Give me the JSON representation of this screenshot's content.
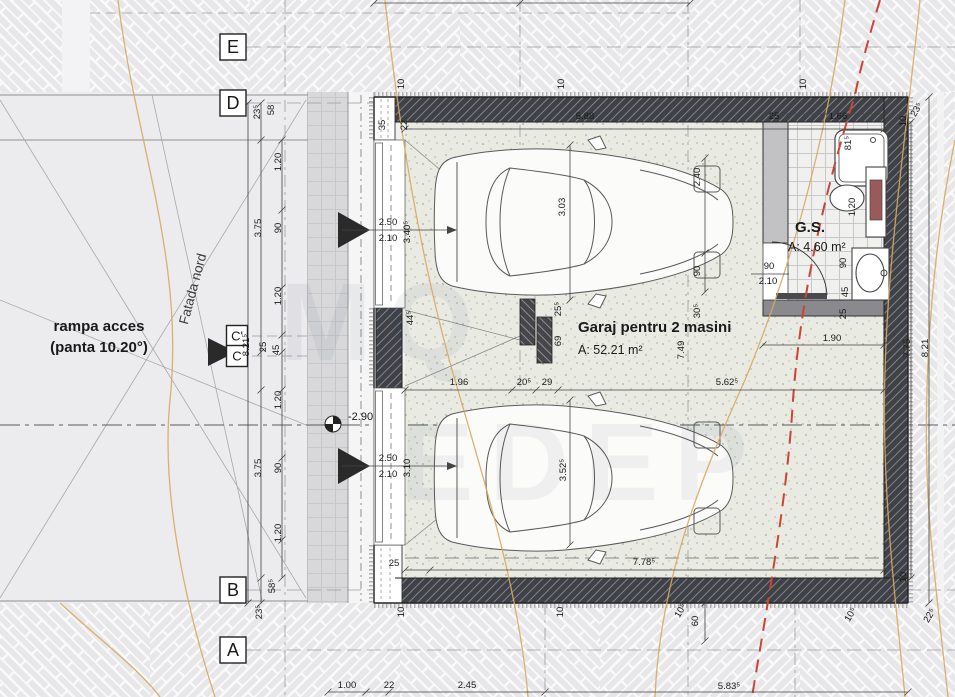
{
  "colors": {
    "wall": "#3f4146",
    "floor_stipple": "#e9ebe3",
    "pavement": "#e7e7e9",
    "tile_line": "#c8c8cb",
    "contour_line": "#d9a95f",
    "boundary_red_dashed": "#cc4433",
    "dimension_text": "#1a1a1a"
  },
  "texts": {
    "garage_title": "Garaj pentru 2 masini",
    "garage_area": "A: 52.21 m²",
    "gs_title": "G.S.",
    "gs_area": "A: 4.60 m²",
    "ramp_line1": "rampa acces",
    "ramp_line2": "(panta 10.20°)",
    "facade": "Fatada nord",
    "level": "-2.90",
    "watermark1": "MQ",
    "watermark2": "EDEP"
  },
  "grid_axes": [
    {
      "label": "E",
      "x": 233,
      "y": 47,
      "s": 26,
      "small": false
    },
    {
      "label": "D",
      "x": 233,
      "y": 103,
      "s": 26,
      "small": false
    },
    {
      "label": "C'",
      "x": 237,
      "y": 336,
      "s": 21,
      "small": true
    },
    {
      "label": "C",
      "x": 237,
      "y": 356,
      "s": 21,
      "small": true
    },
    {
      "label": "B",
      "x": 233,
      "y": 590,
      "s": 26,
      "small": false
    },
    {
      "label": "A",
      "x": 233,
      "y": 650,
      "s": 26,
      "small": false
    }
  ],
  "dimensions": [
    {
      "t": "5.88",
      "x": 585,
      "y": 119
    },
    {
      "t": "35",
      "x": 385,
      "y": 125,
      "r": -90
    },
    {
      "t": "22",
      "x": 407,
      "y": 125,
      "r": -90
    },
    {
      "t": "10",
      "x": 404,
      "y": 84,
      "r": -90
    },
    {
      "t": "10",
      "x": 564,
      "y": 84,
      "r": -90
    },
    {
      "t": "10",
      "x": 806,
      "y": 84,
      "r": -90
    },
    {
      "t": "10",
      "x": 906,
      "y": 121,
      "r": -90
    },
    {
      "t": "23⁵",
      "x": 919,
      "y": 111,
      "r": -60
    },
    {
      "t": "25",
      "x": 774,
      "y": 119
    },
    {
      "t": "1.66",
      "x": 838,
      "y": 119
    },
    {
      "t": "81⁵",
      "x": 851,
      "y": 143,
      "r": -90
    },
    {
      "t": "1.20",
      "x": 855,
      "y": 207,
      "r": -90
    },
    {
      "t": "90",
      "x": 846,
      "y": 263,
      "r": -90
    },
    {
      "t": "45",
      "x": 848,
      "y": 292,
      "r": -90
    },
    {
      "t": "25",
      "x": 846,
      "y": 314,
      "r": -90
    },
    {
      "t": "90",
      "x": 769,
      "y": 269
    },
    {
      "t": "2.10",
      "x": 768,
      "y": 284
    },
    {
      "t": "1.90",
      "x": 832,
      "y": 341
    },
    {
      "t": "3.03",
      "x": 565,
      "y": 207,
      "r": -90
    },
    {
      "t": "2.40",
      "x": 700,
      "y": 177,
      "r": -90
    },
    {
      "t": "90",
      "x": 700,
      "y": 271,
      "r": -90
    },
    {
      "t": "30⁵",
      "x": 700,
      "y": 311,
      "r": -90
    },
    {
      "t": "7.49",
      "x": 684,
      "y": 350,
      "r": -90
    },
    {
      "t": "25⁵",
      "x": 561,
      "y": 309,
      "r": -90
    },
    {
      "t": "69",
      "x": 561,
      "y": 341,
      "r": -90
    },
    {
      "t": "44⁵",
      "x": 413,
      "y": 318,
      "r": -90
    },
    {
      "t": "1.96",
      "x": 459,
      "y": 385
    },
    {
      "t": "20⁵",
      "x": 524,
      "y": 385
    },
    {
      "t": "29",
      "x": 547,
      "y": 385
    },
    {
      "t": "5.62⁵",
      "x": 727,
      "y": 385
    },
    {
      "t": "3.52⁵",
      "x": 566,
      "y": 470,
      "r": -90
    },
    {
      "t": "2.50",
      "x": 388,
      "y": 225
    },
    {
      "t": "2.10",
      "x": 388,
      "y": 241
    },
    {
      "t": "3.40⁵",
      "x": 410,
      "y": 232,
      "r": -90
    },
    {
      "t": "2.50",
      "x": 388,
      "y": 461
    },
    {
      "t": "2.10",
      "x": 388,
      "y": 477
    },
    {
      "t": "3.10",
      "x": 410,
      "y": 468,
      "r": -90
    },
    {
      "t": "7.78⁵",
      "x": 644,
      "y": 565
    },
    {
      "t": "25",
      "x": 394,
      "y": 566
    },
    {
      "t": "23⁵",
      "x": 260,
      "y": 112,
      "r": -90
    },
    {
      "t": "58",
      "x": 274,
      "y": 110,
      "r": -90
    },
    {
      "t": "1.20",
      "x": 281,
      "y": 162,
      "r": -90
    },
    {
      "t": "3.75",
      "x": 261,
      "y": 228,
      "r": -90
    },
    {
      "t": "90",
      "x": 281,
      "y": 228,
      "r": -90
    },
    {
      "t": "1.20",
      "x": 281,
      "y": 296,
      "r": -90
    },
    {
      "t": "8.21⁵",
      "x": 249,
      "y": 345,
      "r": -90
    },
    {
      "t": "25",
      "x": 266,
      "y": 347,
      "r": -90
    },
    {
      "t": "45",
      "x": 279,
      "y": 350,
      "r": -90
    },
    {
      "t": "1.20",
      "x": 281,
      "y": 400,
      "r": -90
    },
    {
      "t": "3.75",
      "x": 261,
      "y": 468,
      "r": -90
    },
    {
      "t": "90",
      "x": 281,
      "y": 468,
      "r": -90
    },
    {
      "t": "1.20",
      "x": 281,
      "y": 533,
      "r": -90
    },
    {
      "t": "58⁵",
      "x": 275,
      "y": 586,
      "r": -90
    },
    {
      "t": "23⁵",
      "x": 262,
      "y": 612,
      "r": -90
    },
    {
      "t": "7.75",
      "x": 910,
      "y": 348,
      "r": -90
    },
    {
      "t": "8.21",
      "x": 928,
      "y": 348,
      "r": -90
    },
    {
      "t": "10",
      "x": 906,
      "y": 577,
      "r": -90
    },
    {
      "t": "10",
      "x": 404,
      "y": 612,
      "r": -90
    },
    {
      "t": "10",
      "x": 563,
      "y": 612,
      "r": -90
    },
    {
      "t": "10⁵",
      "x": 683,
      "y": 612,
      "r": -60
    },
    {
      "t": "60",
      "x": 698,
      "y": 621,
      "r": -90
    },
    {
      "t": "10⁵",
      "x": 853,
      "y": 616,
      "r": -60
    },
    {
      "t": "22⁵",
      "x": 932,
      "y": 617,
      "r": -60
    },
    {
      "t": "1.00",
      "x": 347,
      "y": 688
    },
    {
      "t": "22",
      "x": 389,
      "y": 688
    },
    {
      "t": "2.45",
      "x": 467,
      "y": 688
    },
    {
      "t": "5.83⁵",
      "x": 729,
      "y": 689
    }
  ]
}
